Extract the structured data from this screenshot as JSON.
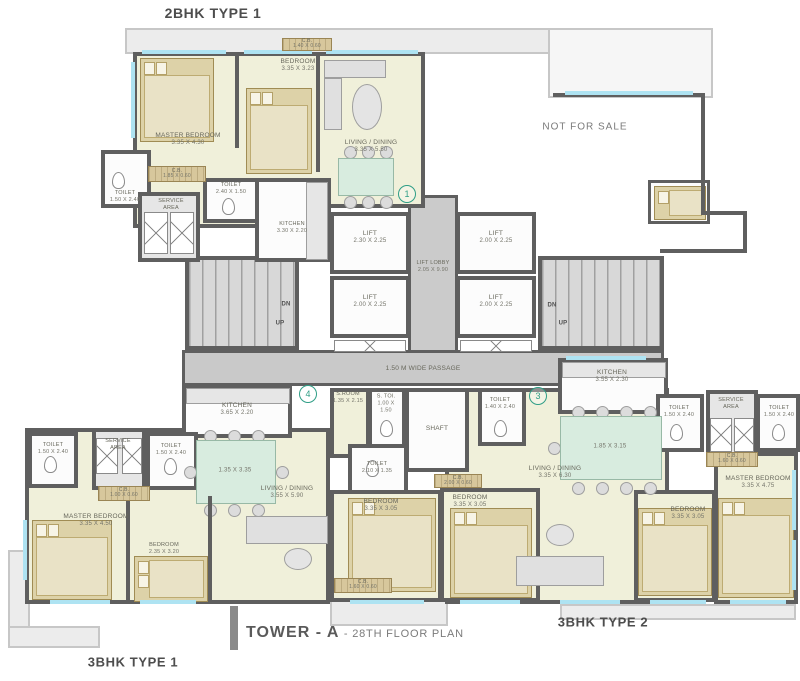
{
  "footer": {
    "title": "TOWER - A",
    "subtitle": "- 28TH FLOOR PLAN"
  },
  "unit_titles": {
    "top_left": "2BHK TYPE 1",
    "bottom_left": "3BHK TYPE 1",
    "bottom_right": "3BHK TYPE 2",
    "not_for_sale": "NOT FOR SALE"
  },
  "unit_numbers": {
    "u1": "1",
    "u3": "3",
    "u4": "4"
  },
  "colors": {
    "wall": "#5f5f5f",
    "room": "#f0f0da",
    "window": "#aee3f2",
    "accent": "#2f9e86",
    "furniture": "#ddd2a8",
    "deck": "#ececec"
  },
  "core": {
    "lift_tl": {
      "name": "LIFT",
      "dim": "2.30 X 2.25"
    },
    "lift_tr": {
      "name": "LIFT",
      "dim": "2.00 X 2.25"
    },
    "lift_bl": {
      "name": "LIFT",
      "dim": "2.00 X 2.25"
    },
    "lift_br": {
      "name": "LIFT",
      "dim": "2.00 X 2.25"
    },
    "lobby": {
      "name": "LIFT LOBBY",
      "dim": "2.05 X 9.90"
    },
    "passage": "1.50 M WIDE PASSAGE",
    "shaft": "SHAFT",
    "dn": "DN",
    "up": "UP"
  },
  "unit1": {
    "master_bedroom": {
      "name": "MASTER BEDROOM",
      "dim": "3.35 X 4.30"
    },
    "bedroom": {
      "name": "BEDROOM",
      "dim": "3.35 X 3.23"
    },
    "cb_top": {
      "name": "C.B.",
      "dim": "1.40 X 0.60"
    },
    "living": {
      "name": "LIVING / DINING",
      "dim": "3.35 X 5.50"
    },
    "kitchen": {
      "name": "KITCHEN",
      "dim": "3.30 X 2.20"
    },
    "toilet_inner": {
      "name": "TOILET",
      "dim": "2.40 X 1.50"
    },
    "toilet_left": {
      "name": "TOILET",
      "dim": "1.50 X 2.40"
    },
    "cb_left": {
      "name": "C.B.",
      "dim": "1.85 X 0.60"
    },
    "service_area": "SERVICE AREA"
  },
  "unit4": {
    "kitchen": {
      "name": "KITCHEN",
      "dim": "3.65 X 2.20"
    },
    "table_dim": "1.35 X 3.35",
    "living": {
      "name": "LIVING / DINING",
      "dim": "3.55 X 5.90"
    },
    "master_bedroom": {
      "name": "MASTER BEDROOM",
      "dim": "3.35 X 4.50"
    },
    "bedroom1": {
      "name": "BEDROOM",
      "dim": "2.35 X 3.20"
    },
    "bedroom2": {
      "name": "BEDROOM",
      "dim": "3.35 X 3.05"
    },
    "toilet_left": {
      "name": "TOILET",
      "dim": "1.50 X 2.40"
    },
    "toilet_mid": {
      "name": "TOILET",
      "dim": "1.50 X 2.40"
    },
    "service_area": "SERVICE AREA",
    "cb_service": {
      "name": "C.B.",
      "dim": "1.00 X 0.60"
    },
    "sroom": {
      "name": "S.ROOM",
      "dim": "1.35 X 2.15"
    },
    "stoi": {
      "name": "S. TOI.",
      "dim": "1.00 X 1.50"
    },
    "toilet_inner": {
      "name": "TOILET",
      "dim": "2.10 X 1.35"
    },
    "cb_bottom": {
      "name": "C.B.",
      "dim": "1.60 X 0.60"
    }
  },
  "unit3": {
    "toilet_entry": {
      "name": "TOILET",
      "dim": "1.40 X 2.40"
    },
    "kitchen": {
      "name": "KITCHEN",
      "dim": "3.55 X 2.30"
    },
    "table_dim": "1.85 X 3.15",
    "living": {
      "name": "LIVING / DINING",
      "dim": "3.35 X 6.30"
    },
    "bedroom1": {
      "name": "BEDROOM",
      "dim": "3.35 X 3.05"
    },
    "bedroom2": {
      "name": "BEDROOM",
      "dim": "3.35 X 3.05"
    },
    "master_bedroom": {
      "name": "MASTER BEDROOM",
      "dim": "3.35 X 4.75"
    },
    "cb_mid": {
      "name": "C.B.",
      "dim": "2.00 X 0.60"
    },
    "toilet_r1": {
      "name": "TOILET",
      "dim": "1.50 X 2.40"
    },
    "toilet_r2": {
      "name": "TOILET",
      "dim": "1.50 X 2.40"
    },
    "service_area": "SERVICE AREA",
    "cb_right": {
      "name": "C.B.",
      "dim": "1.60 X 0.60"
    }
  }
}
